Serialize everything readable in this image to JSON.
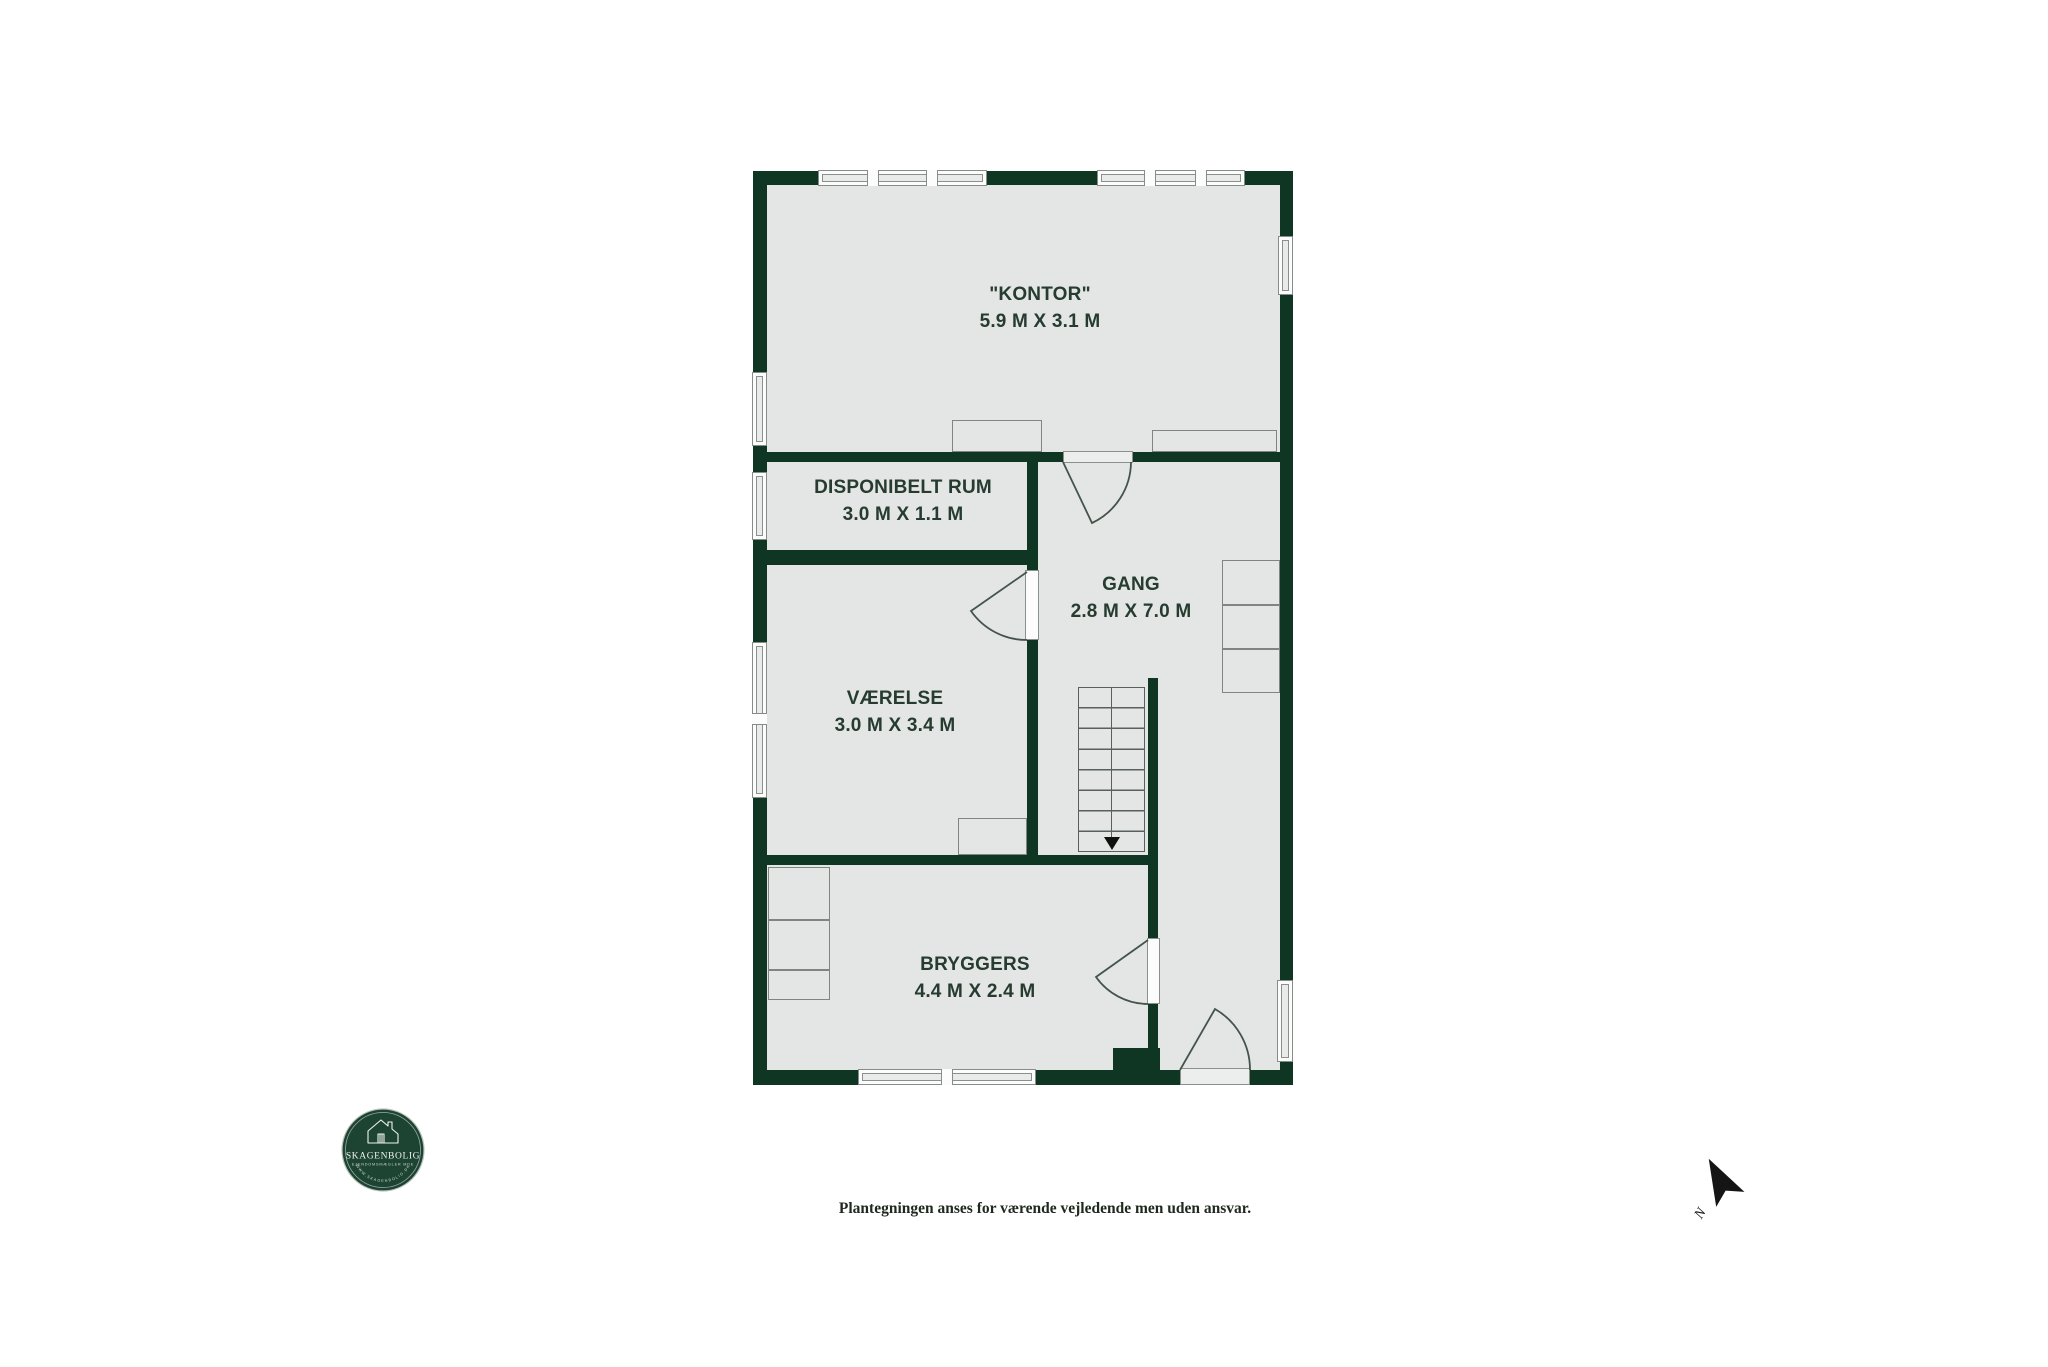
{
  "plan": {
    "rooms": [
      {
        "name": "\"KONTOR\"",
        "dims": "5.9 M X 3.1 M"
      },
      {
        "name": "DISPONIBELT RUM",
        "dims": "3.0 M X 1.1 M"
      },
      {
        "name": "GANG",
        "dims": "2.8 M X 7.0 M"
      },
      {
        "name": "VÆRELSE",
        "dims": "3.0 M X 3.4 M"
      },
      {
        "name": "BRYGGERS",
        "dims": "4.4 M X 2.4 M"
      }
    ]
  },
  "footer": {
    "disclaimer": "Plantegningen anses for værende vejledende men uden ansvar."
  },
  "logo": {
    "brand": "SKAGENBOLIG",
    "tagline": "EJENDOMSMÆGLER MDE",
    "website": "WWW.SKAGENBOLIG.DK"
  },
  "compass": {
    "north_label": "N"
  },
  "colors": {
    "wall": "#0f3622",
    "floor": "#e4e6e5",
    "logo_green": "#1d4433",
    "label_text": "#273c30"
  }
}
